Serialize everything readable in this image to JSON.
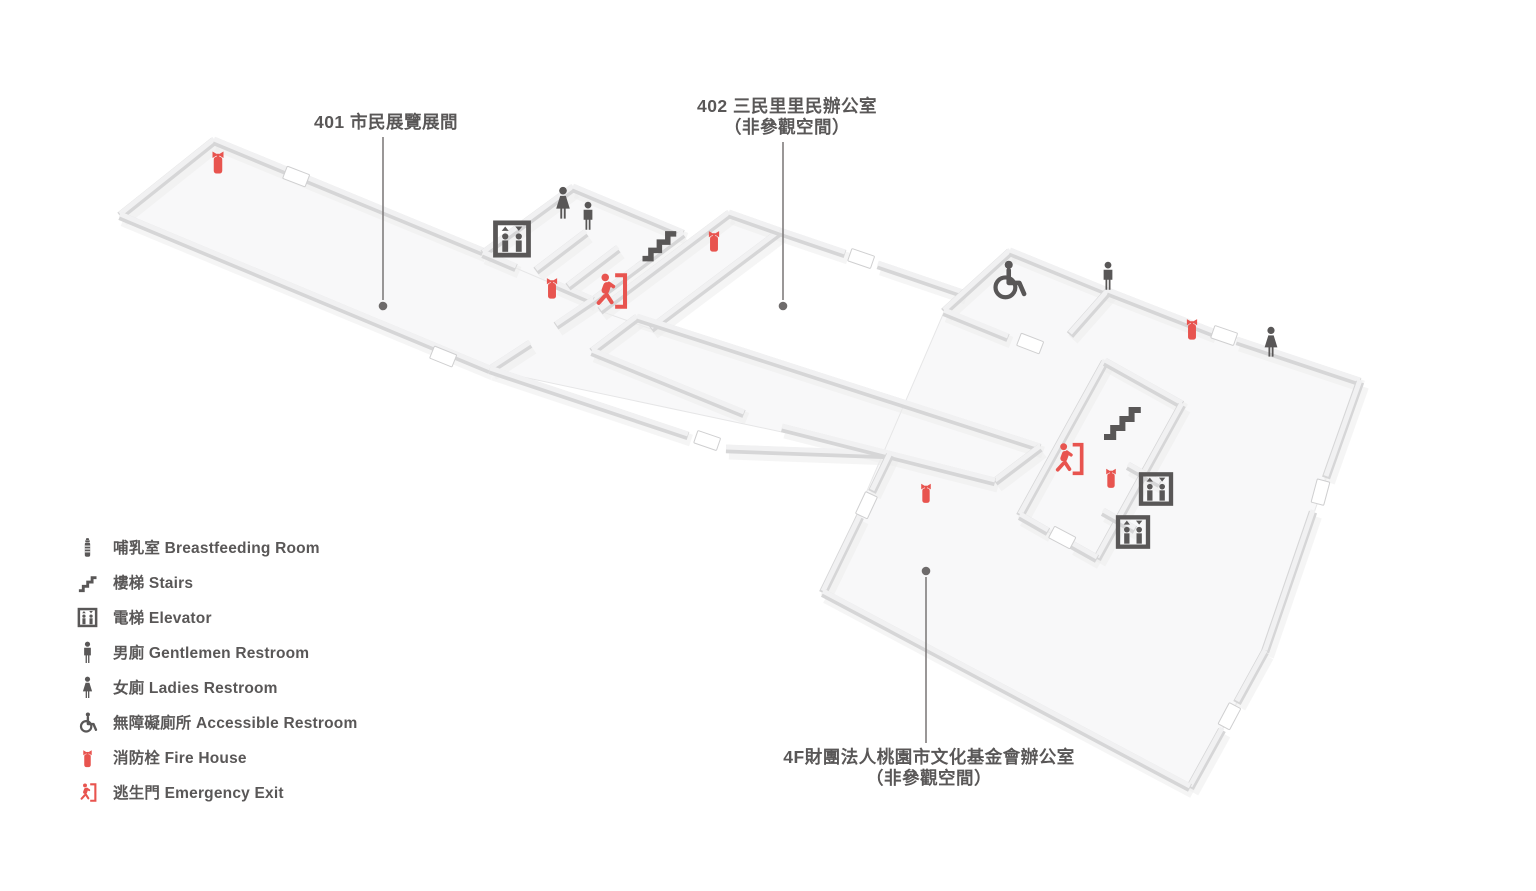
{
  "colors": {
    "text_gray": "#595757",
    "icon_gray": "#595757",
    "icon_red": "#e8544f",
    "leader_line": "#807d7d",
    "leader_dot": "#6e6b6b",
    "wall_edge": "#d6d6d7",
    "wall_top": "#f1f1f2",
    "floor_fill": "#f8f8f9"
  },
  "map": {
    "area_labels": [
      {
        "name": "area-label-401",
        "lines": [
          "401 市民展覽展間"
        ],
        "x": 386,
        "y": 112,
        "anchor_x": 383,
        "anchor_y": 306
      },
      {
        "name": "area-label-402",
        "lines": [
          "402 三民里里民辦公室",
          "（非參觀空間）"
        ],
        "x": 787,
        "y": 96,
        "anchor_x": 783,
        "anchor_y": 306
      },
      {
        "name": "area-label-4f",
        "lines": [
          "4F財團法人桃園市文化基金會辦公室",
          "（非參觀空間）"
        ],
        "x": 929,
        "y": 747,
        "anchor_x": 926,
        "anchor_y": 571
      }
    ],
    "markers": [
      {
        "type": "fire-extinguisher",
        "x": 218,
        "y": 161,
        "w": 30,
        "h": 46
      },
      {
        "type": "elevator",
        "x": 512,
        "y": 239,
        "w": 44,
        "h": 44
      },
      {
        "type": "ladies-restroom",
        "x": 563,
        "y": 203,
        "w": 34,
        "h": 48
      },
      {
        "type": "gentlemen-restroom",
        "x": 588,
        "y": 216,
        "w": 30,
        "h": 44
      },
      {
        "type": "fire-extinguisher",
        "x": 552,
        "y": 287,
        "w": 28,
        "h": 44
      },
      {
        "type": "emergency-exit",
        "x": 610,
        "y": 291,
        "w": 44,
        "h": 44
      },
      {
        "type": "stairs",
        "x": 659,
        "y": 243,
        "w": 46,
        "h": 44
      },
      {
        "type": "fire-extinguisher",
        "x": 714,
        "y": 240,
        "w": 28,
        "h": 44
      },
      {
        "type": "accessible-restroom",
        "x": 1008,
        "y": 280,
        "w": 46,
        "h": 44
      },
      {
        "type": "gentlemen-restroom",
        "x": 1108,
        "y": 276,
        "w": 30,
        "h": 44
      },
      {
        "type": "fire-extinguisher",
        "x": 1192,
        "y": 328,
        "w": 28,
        "h": 44
      },
      {
        "type": "ladies-restroom",
        "x": 1271,
        "y": 342,
        "w": 32,
        "h": 46
      },
      {
        "type": "stairs",
        "x": 1122,
        "y": 420,
        "w": 50,
        "h": 48
      },
      {
        "type": "emergency-exit",
        "x": 1068,
        "y": 459,
        "w": 40,
        "h": 40
      },
      {
        "type": "fire-extinguisher",
        "x": 1111,
        "y": 477,
        "w": 26,
        "h": 40
      },
      {
        "type": "elevator",
        "x": 1156,
        "y": 489,
        "w": 40,
        "h": 40
      },
      {
        "type": "elevator",
        "x": 1133,
        "y": 532,
        "w": 40,
        "h": 40
      },
      {
        "type": "fire-extinguisher",
        "x": 926,
        "y": 492,
        "w": 26,
        "h": 40
      }
    ]
  },
  "legend": {
    "items": [
      {
        "icon": "breastfeeding-room",
        "color": "gray",
        "label": "哺乳室 Breastfeeding Room"
      },
      {
        "icon": "stairs",
        "color": "gray",
        "label": "樓梯 Stairs"
      },
      {
        "icon": "elevator",
        "color": "gray",
        "label": "電梯 Elevator"
      },
      {
        "icon": "gentlemen-restroom",
        "color": "gray",
        "label": "男廁 Gentlemen Restroom"
      },
      {
        "icon": "ladies-restroom",
        "color": "gray",
        "label": "女廁 Ladies Restroom"
      },
      {
        "icon": "accessible-restroom",
        "color": "gray",
        "label": "無障礙廁所  Accessible Restroom"
      },
      {
        "icon": "fire-extinguisher",
        "color": "red",
        "label": "消防栓 Fire House"
      },
      {
        "icon": "emergency-exit",
        "color": "red",
        "label": "逃生門 Emergency Exit"
      }
    ]
  }
}
